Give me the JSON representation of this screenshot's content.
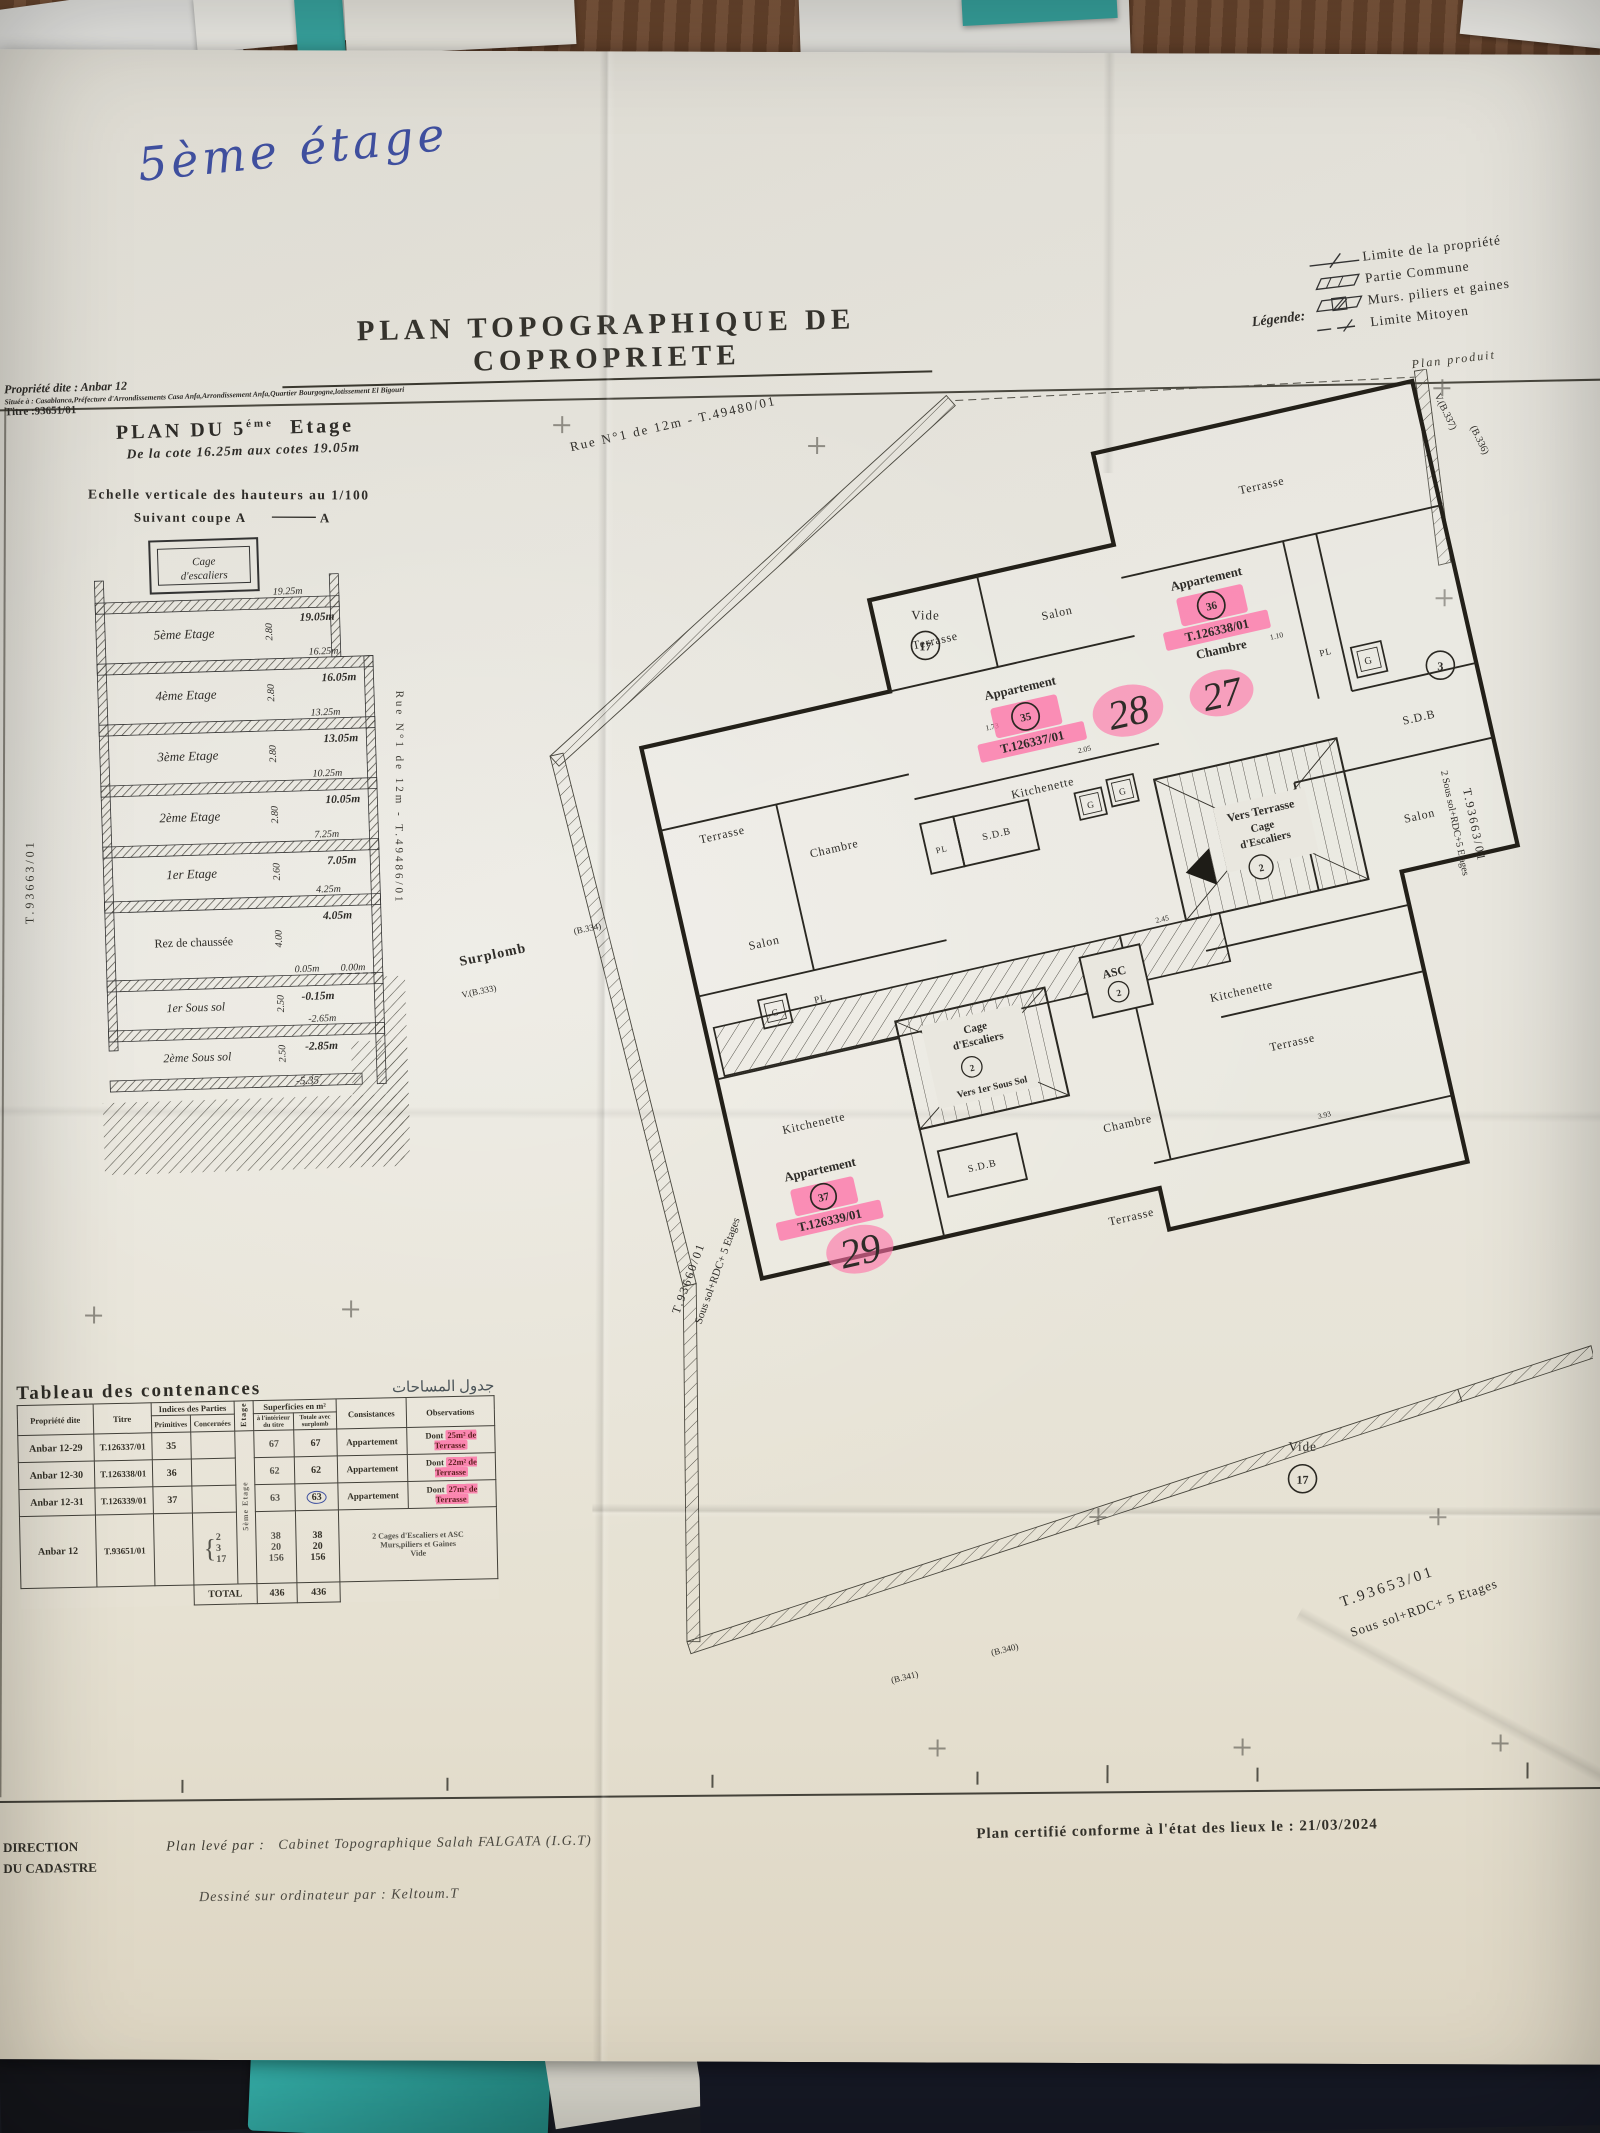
{
  "annotations": {
    "handwritten_title": "5ème étage",
    "hw27": "27",
    "hw28": "28",
    "hw29": "29"
  },
  "header": {
    "property_line1": "Propriété dite : Anbar 12",
    "property_line2": "Située à : Casablanca,Préfecture d'Arrondissements Casa Anfa,Arrondissement Anfa,Quartier Bourgogne,lotissement El Bigouri",
    "property_line3": "Titre :93651/01",
    "title": "PLAN TOPOGRAPHIQUE DE COPROPRIETE",
    "plan_produit": "Plan produit"
  },
  "legend": {
    "label": "Légende:",
    "items": [
      "Limite de la propriété",
      "Partie Commune",
      "Murs. piliers et gaines",
      "Limite Mitoyen"
    ]
  },
  "floor_header": {
    "main": "PLAN DU 5",
    "sup": "éme",
    "tail": "Etage",
    "sub": "De la cote 16.25m aux cotes 19.05m"
  },
  "section": {
    "title": "Echelle verticale des hauteurs au 1/100",
    "subtitle": "Suivant coupe A",
    "subtitle_end": "A",
    "cage1": "Cage",
    "cage2": "d'escaliers",
    "labels": [
      "5ème Etage",
      "4ème Etage",
      "3ème Etage",
      "2ème Etage",
      "1er Etage",
      "Rez de chaussée",
      "1er Sous sol",
      "2ème Sous sol"
    ],
    "heights": [
      "2.80",
      "2.80",
      "2.80",
      "2.80",
      "2.60",
      "4.00",
      "2.50",
      "2.50"
    ],
    "cotes_upper": [
      "19.25m",
      "16.25m",
      "13.25m",
      "10.25m",
      "7.25m",
      "4.25m",
      "0.05m",
      "-2.65m"
    ],
    "cotes_lower": [
      "19.05m",
      "16.05m",
      "13.05m",
      "10.05m",
      "7.05m",
      "4.05m",
      "-0.15m",
      "-2.85m",
      "-5.35"
    ],
    "zero": "0.00m",
    "left_ref": "T.93663/01",
    "street_ref": "Rue N°1 de 12m - T.49486/01"
  },
  "table": {
    "title": "Tableau des contenances",
    "title_ar": "جدول المساحات",
    "h_prop": "Propriété dite",
    "h_titre": "Titre",
    "h_indices": "Indices des Parties",
    "h_prim": "Primitives",
    "h_conc": "Concernées",
    "h_etage": "Etage",
    "h_sup": "Superficies en m²",
    "h_sup1": "à l'intérieur du titre",
    "h_sup2": "Totale avec surplomb",
    "h_cons": "Consistances",
    "h_obs": "Observations",
    "etage_val": "5ème Etage",
    "rows": [
      {
        "prop": "Anbar 12-29",
        "titre": "T.126337/01",
        "prim": "35",
        "sup1": "67",
        "sup2": "67",
        "cons": "Appartement",
        "obs_prefix": "Dont",
        "obs_value": "25m² de Terrasse"
      },
      {
        "prop": "Anbar 12-30",
        "titre": "T.126338/01",
        "prim": "36",
        "sup1": "62",
        "sup2": "62",
        "cons": "Appartement",
        "obs_prefix": "Dont",
        "obs_value": "22m² de Terrasse"
      },
      {
        "prop": "Anbar 12-31",
        "titre": "T.126339/01",
        "prim": "37",
        "sup1": "63",
        "sup2": "63",
        "cons": "Appartement",
        "obs_prefix": "Dont",
        "obs_value": "27m² de Terrasse"
      }
    ],
    "common": {
      "prop": "Anbar 12",
      "titre": "T.93651/01",
      "conc1": "2",
      "conc2": "3",
      "conc3": "17",
      "v1a": "38",
      "v1b": "38",
      "v2a": "20",
      "v2b": "20",
      "v3a": "156",
      "v3b": "156",
      "cons1": "2 Cages d'Escaliers et ASC",
      "cons2": "Murs,piliers et Gaines",
      "cons3": "Vide"
    },
    "total_label": "TOTAL",
    "total1": "436",
    "total2": "436"
  },
  "plan": {
    "street": "Rue N°1 de 12m - T.49480/01",
    "rooms": {
      "terrasse": "Terrasse",
      "salon": "Salon",
      "chambre": "Chambre",
      "kitchenette": "Kitchenette",
      "sdb": "S.D.B",
      "pl": "PL",
      "g": "G",
      "asc": "ASC",
      "vide": "Vide"
    },
    "apt36": {
      "name": "Appartement",
      "num": "36",
      "titre": "T.126338/01",
      "room": "Chambre"
    },
    "apt35": {
      "name": "Appartement",
      "num": "35",
      "titre": "T.126337/01"
    },
    "apt37": {
      "name": "Appartement",
      "num": "37",
      "titre": "T.126339/01"
    },
    "st1a": "Vers Terrasse",
    "st1b": "Cage",
    "st1c": "d'Escaliers",
    "st1n": "2",
    "st2a": "Cage",
    "st2b": "d'Escaliers",
    "st2n": "2",
    "st2c": "Vers 1er Sous Sol",
    "asc_n": "2",
    "vide_n": "17",
    "pc3": "3",
    "surplomb": "Surplomb",
    "marks": {
      "b337": "V.(B.337)",
      "b336": "(B.336)",
      "b333": "V.(B.333)",
      "b334": "(B.334)",
      "b341": "(B.341)",
      "b340": "(B.340)"
    },
    "refs": {
      "br1": "T.93653/01",
      "br2": "Sous sol+RDC+ 5 Etages",
      "bl1": "T.93660/01",
      "bl2": "Sous sol+RDC+ 5 Etages",
      "r1": "T.93663/01",
      "r2": "2 Sous sol+RDC+5 Etages"
    },
    "dims": [
      "2.05",
      "1.73",
      "1.10",
      "2.45",
      "3.93"
    ]
  },
  "footer": {
    "dir1": "DIRECTION",
    "dir2": "DU CADASTRE",
    "leve_label": "Plan levé par :",
    "leve_value": "Cabinet Topographique Salah FALGATA (I.G.T)",
    "dessine": "Dessiné sur ordinateur par : Keltoum.T",
    "certifie": "Plan certifié conforme à l'état des lieux le : 21/03/2024"
  }
}
